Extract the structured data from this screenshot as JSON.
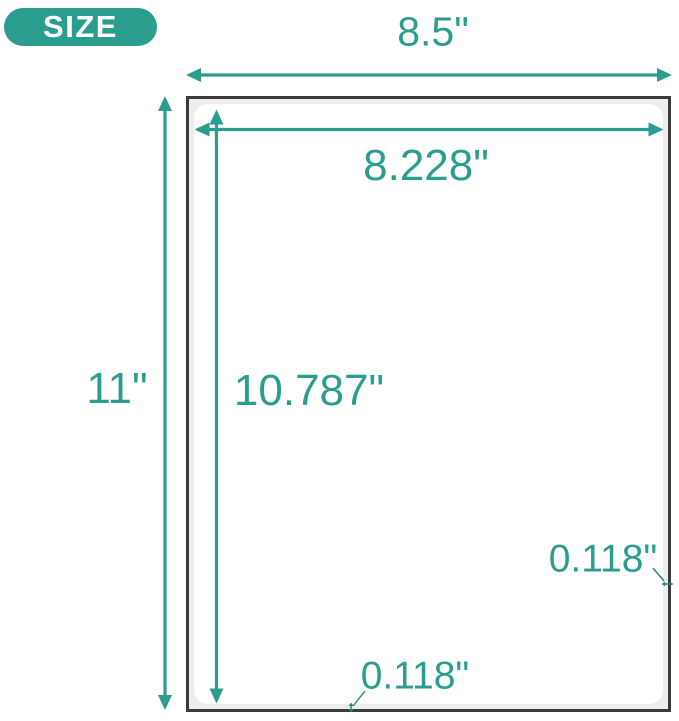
{
  "colors": {
    "accent": "#2A9D8F",
    "page_border": "#3B3B3B",
    "page_fill": "#ECECEC",
    "label_fill": "#FFFFFF",
    "leader": "#2F7D73"
  },
  "badge": {
    "label": "SIZE"
  },
  "dimensions": {
    "sheet_width": "8.5\"",
    "sheet_height": "11\"",
    "label_width": "8.228\"",
    "label_height": "10.787\"",
    "right_margin": "0.118\"",
    "bottom_margin": "0.118\""
  }
}
